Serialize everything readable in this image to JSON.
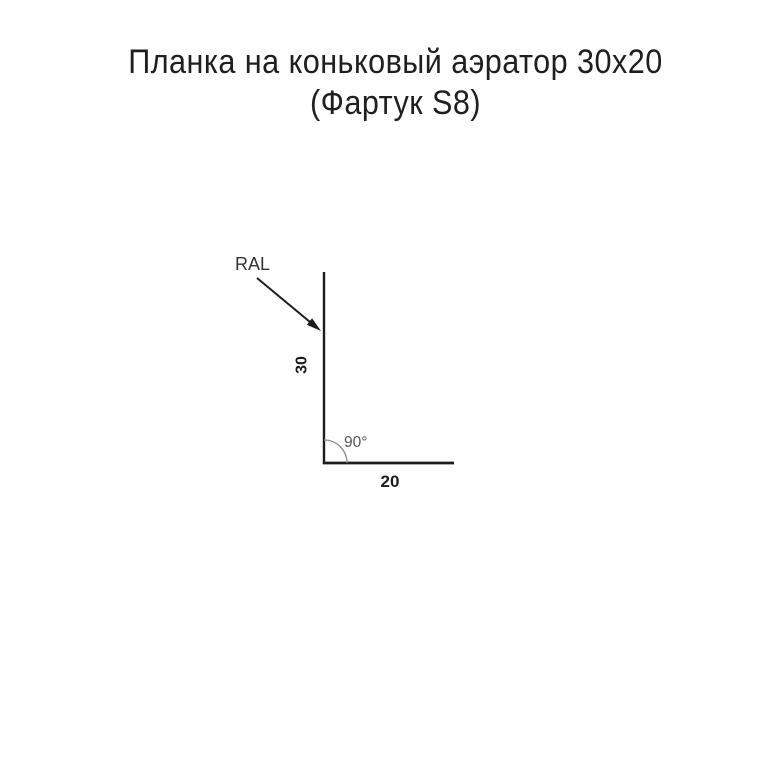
{
  "page": {
    "background": "#ffffff"
  },
  "title": {
    "line1": "Планка на коньковый аэратор 30x20",
    "line2": "(Фартук S8)"
  },
  "diagram": {
    "ral_label": "RAL",
    "height_label": "30",
    "width_label": "20",
    "angle_label": "90°",
    "colors": {
      "profile_line": "#1c1c1c",
      "dimension_text": "#1c1c1c",
      "ral_text": "#333333",
      "arrow": "#1c1c1c",
      "arc": "#8a8a8a",
      "angle_text": "#555555"
    }
  }
}
